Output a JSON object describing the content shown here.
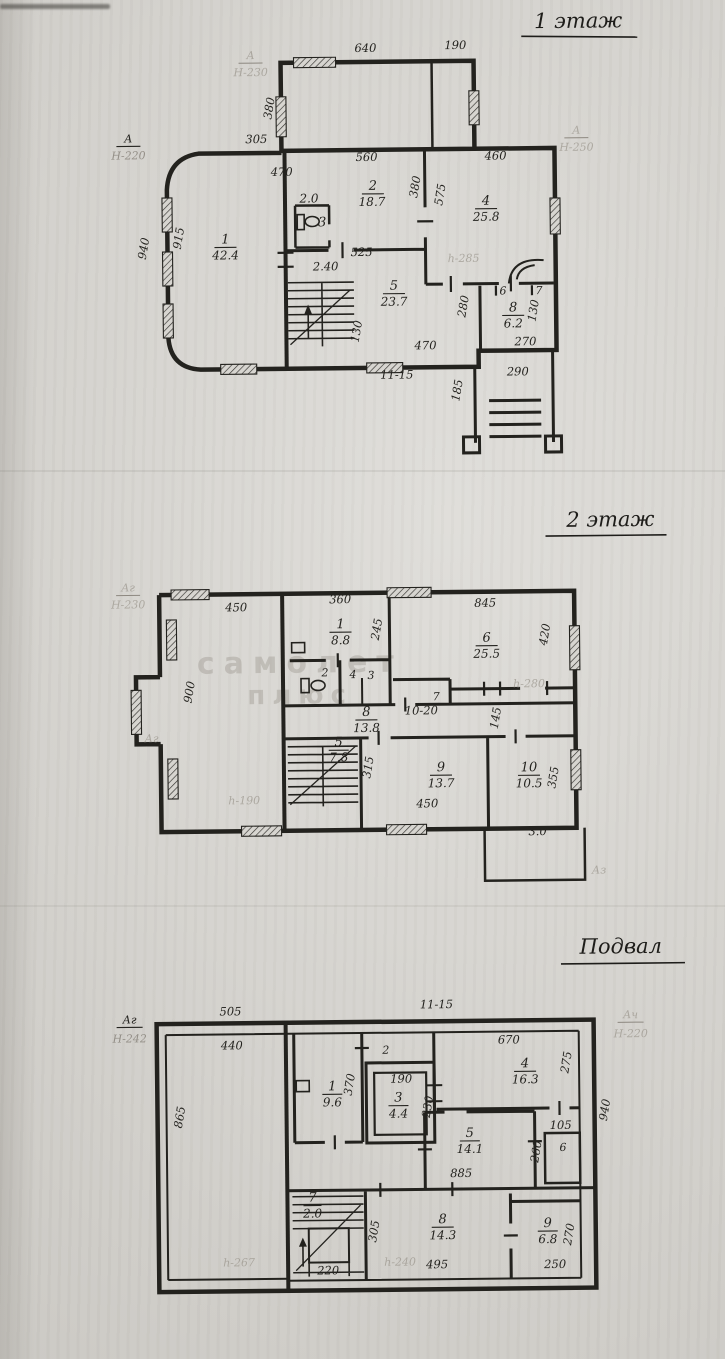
{
  "palette": {
    "paper": "#d7d5d0",
    "ink": "#23221e",
    "pencil": "#8d8880",
    "watermark": "#9b968e"
  },
  "f1": {
    "title": "1 этаж",
    "markers": {
      "left": "А",
      "left_h": "Н-220",
      "right": "А",
      "right_h": "Н-250",
      "top": "А",
      "top_h": "Н-230"
    },
    "note_h285": "h-285",
    "dims": {
      "d640": "640",
      "d190": "190",
      "d380a": "380",
      "d305": "305",
      "d470a": "470",
      "d940": "940",
      "d915": "915",
      "d560": "560",
      "d460": "460",
      "d380b": "380",
      "d575": "575",
      "d525": "525",
      "d240": "2.40",
      "d280": "280",
      "d130a": "130",
      "d270": "270",
      "d290": "290",
      "d185": "185",
      "d470b": "470",
      "d1115": "11-15",
      "d130b": "130"
    },
    "rooms": {
      "r1": {
        "n": "1",
        "a": "42.4"
      },
      "r2": {
        "n": "2",
        "a": "18.7"
      },
      "r3": {
        "n": "3",
        "a": "2.0"
      },
      "r4": {
        "n": "4",
        "a": "25.8"
      },
      "r5": {
        "n": "5",
        "a": "23.7"
      },
      "r6": {
        "n": "6"
      },
      "r7": {
        "n": "7"
      },
      "r8": {
        "n": "8",
        "a": "6.2"
      }
    }
  },
  "f2": {
    "title": "2 этаж",
    "markers": {
      "tl": "Аг",
      "tl_h": "Н-230",
      "left": "Аг",
      "br": "Аз"
    },
    "notes": {
      "h280": "h-280",
      "h190": "h-190"
    },
    "watermark": {
      "line1": "самолет",
      "line2": "плюс"
    },
    "dims": {
      "d450a": "450",
      "d360": "360",
      "d845": "845",
      "d245": "245",
      "d420": "420",
      "d900": "900",
      "d1020": "10-20",
      "d145": "145",
      "d315": "315",
      "d450b": "450",
      "d355": "355",
      "d30": "3.0"
    },
    "rooms": {
      "r1": {
        "n": "1",
        "a": "8.8"
      },
      "r2": {
        "n": "2"
      },
      "r3": {
        "n": "3"
      },
      "r4": {
        "n": "4"
      },
      "r5": {
        "n": "5",
        "a": "7.8"
      },
      "r6": {
        "n": "6",
        "a": "25.5"
      },
      "r7": {
        "n": "7"
      },
      "r8": {
        "n": "8",
        "a": "13.8"
      },
      "r9": {
        "n": "9",
        "a": "13.7"
      },
      "r10": {
        "n": "10",
        "a": "10.5"
      }
    }
  },
  "f3": {
    "title": "Подвал",
    "markers": {
      "tl": "Аг",
      "tl_h": "Н-242",
      "tr": "Ач",
      "tr_h": "Н-220"
    },
    "notes": {
      "h267": "h-267",
      "h240": "h-240"
    },
    "dims": {
      "d505": "505",
      "d1115": "11-15",
      "d440": "440",
      "d865": "865",
      "d370": "370",
      "d190": "190",
      "d230": "230",
      "d670": "670",
      "d275": "275",
      "d940": "940",
      "d105": "105",
      "d260": "260",
      "d885": "885",
      "d305": "305",
      "d495": "495",
      "d220": "220",
      "d270": "270",
      "d250": "250"
    },
    "rooms": {
      "r1": {
        "n": "1",
        "a": "9.6"
      },
      "r2": {
        "n": "2"
      },
      "r3": {
        "n": "3",
        "a": "4.4"
      },
      "r4": {
        "n": "4",
        "a": "16.3"
      },
      "r5": {
        "n": "5",
        "a": "14.1"
      },
      "r6": {
        "n": "6"
      },
      "r7": {
        "n": "7",
        "a": "2.0"
      },
      "r8": {
        "n": "8",
        "a": "14.3"
      },
      "r9": {
        "n": "9",
        "a": "6.8"
      }
    }
  }
}
